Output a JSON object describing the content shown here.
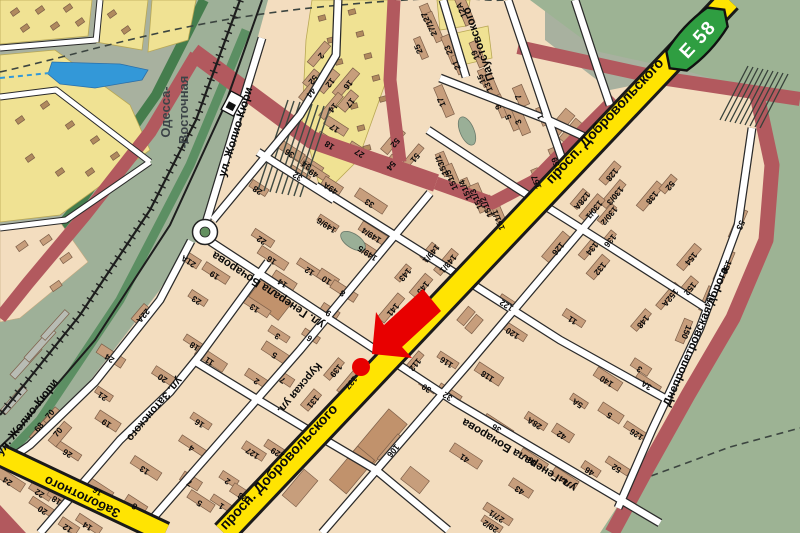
{
  "map": {
    "route_badge": {
      "text": "E 58",
      "color": "#2f9e41"
    },
    "station": {
      "line1": "Одесса-",
      "line2": "-Восточная"
    },
    "marker": {
      "type": "arrow-and-dot",
      "color": "#e80000"
    },
    "street_labels": [
      {
        "text": "просп. Добровольского",
        "x": 608,
        "y": 124,
        "r": -47,
        "s": 14
      },
      {
        "text": "просп. Добровольского",
        "x": 282,
        "y": 470,
        "r": -47,
        "s": 14
      },
      {
        "text": "Заболотного",
        "x": 84,
        "y": 493,
        "r": 205,
        "s": 13
      },
      {
        "text": "ул. Жолио-Кюри",
        "x": 239,
        "y": 133,
        "r": -73,
        "s": 11.5
      },
      {
        "text": "ул. Жолио-Кюри",
        "x": 30,
        "y": 419,
        "r": -52,
        "s": 11.5
      },
      {
        "text": "ул. Затонского",
        "x": 152,
        "y": 407,
        "r": 130,
        "s": 11
      },
      {
        "text": "Курская ул.",
        "x": 297,
        "y": 386,
        "r": 130,
        "s": 11
      },
      {
        "text": "ул. Генерала Бочарова",
        "x": 270,
        "y": 287,
        "r": 213,
        "s": 11.5
      },
      {
        "text": "ул. Генерала Бочарова",
        "x": 521,
        "y": 452,
        "r": 211,
        "s": 11.5
      },
      {
        "text": "Паустовского",
        "x": 482,
        "y": 43,
        "r": 251,
        "s": 11.5
      },
      {
        "text": "Днепропетровская дорога",
        "x": 699,
        "y": 338,
        "r": -67,
        "s": 11.5
      }
    ],
    "numbers": [
      {
        "t": "143",
        "x": 403,
        "y": 273,
        "r": 130
      },
      {
        "t": "145",
        "x": 421,
        "y": 286,
        "r": 130
      },
      {
        "t": "141",
        "x": 391,
        "y": 308,
        "r": 130
      },
      {
        "t": "139",
        "x": 334,
        "y": 369,
        "r": 130
      },
      {
        "t": "137",
        "x": 349,
        "y": 381,
        "r": 130
      },
      {
        "t": "131",
        "x": 311,
        "y": 400,
        "r": 130
      },
      {
        "t": "143/1",
        "x": 446,
        "y": 262,
        "r": 130
      },
      {
        "t": "149/1",
        "x": 429,
        "y": 252,
        "r": 130
      },
      {
        "t": "112",
        "x": 413,
        "y": 363,
        "r": 130
      },
      {
        "t": "126",
        "x": 556,
        "y": 247,
        "r": 130
      },
      {
        "t": "128",
        "x": 610,
        "y": 173,
        "r": 130
      },
      {
        "t": "130/3",
        "x": 613,
        "y": 194,
        "r": 130
      },
      {
        "t": "130/2",
        "x": 607,
        "y": 214,
        "r": 130
      },
      {
        "t": "130/1",
        "x": 592,
        "y": 208,
        "r": 130
      },
      {
        "t": "128А",
        "x": 580,
        "y": 199,
        "r": 130
      },
      {
        "t": "134",
        "x": 590,
        "y": 247,
        "r": 130
      },
      {
        "t": "136",
        "x": 608,
        "y": 239,
        "r": 130
      },
      {
        "t": "132",
        "x": 598,
        "y": 267,
        "r": 130
      },
      {
        "t": "138",
        "x": 650,
        "y": 196,
        "r": 130
      },
      {
        "t": "148",
        "x": 641,
        "y": 320,
        "r": 130
      },
      {
        "t": "152А",
        "x": 668,
        "y": 296,
        "r": 130
      },
      {
        "t": "152",
        "x": 688,
        "y": 287,
        "r": 130
      },
      {
        "t": "154",
        "x": 689,
        "y": 257,
        "r": 130
      },
      {
        "t": "52",
        "x": 668,
        "y": 184,
        "r": 130
      },
      {
        "t": "154",
        "x": 707,
        "y": 299,
        "r": 113
      },
      {
        "t": "156",
        "x": 724,
        "y": 266,
        "r": 113
      },
      {
        "t": "150",
        "x": 684,
        "y": 331,
        "r": 113
      },
      {
        "t": "53",
        "x": 738,
        "y": 224,
        "r": 113
      },
      {
        "t": "116",
        "x": 448,
        "y": 360,
        "r": 213
      },
      {
        "t": "118",
        "x": 489,
        "y": 374,
        "r": 213
      },
      {
        "t": "122",
        "x": 508,
        "y": 303,
        "r": 213
      },
      {
        "t": "120",
        "x": 514,
        "y": 331,
        "r": 213
      },
      {
        "t": "30",
        "x": 428,
        "y": 386,
        "r": 213
      },
      {
        "t": "32",
        "x": 449,
        "y": 394,
        "r": 213
      },
      {
        "t": "36",
        "x": 498,
        "y": 426,
        "r": 213
      },
      {
        "t": "28А",
        "x": 536,
        "y": 421,
        "r": 213
      },
      {
        "t": "40",
        "x": 534,
        "y": 459,
        "r": 213
      },
      {
        "t": "42",
        "x": 563,
        "y": 433,
        "r": 213
      },
      {
        "t": "44",
        "x": 565,
        "y": 478,
        "r": 213
      },
      {
        "t": "46",
        "x": 591,
        "y": 469,
        "r": 213
      },
      {
        "t": "52",
        "x": 618,
        "y": 466,
        "r": 213
      },
      {
        "t": "41",
        "x": 466,
        "y": 456,
        "r": 213
      },
      {
        "t": "43",
        "x": 521,
        "y": 488,
        "r": 213
      },
      {
        "t": "27/1",
        "x": 498,
        "y": 514,
        "r": 213
      },
      {
        "t": "29/2",
        "x": 492,
        "y": 524,
        "r": 213
      },
      {
        "t": "140",
        "x": 608,
        "y": 379,
        "r": 213
      },
      {
        "t": "3",
        "x": 641,
        "y": 367,
        "r": 213
      },
      {
        "t": "3А",
        "x": 648,
        "y": 383,
        "r": 213
      },
      {
        "t": "5А",
        "x": 579,
        "y": 401,
        "r": 213
      },
      {
        "t": "5",
        "x": 611,
        "y": 413,
        "r": 213
      },
      {
        "t": "106",
        "x": 391,
        "y": 449,
        "r": 130
      },
      {
        "t": "11",
        "x": 574,
        "y": 318,
        "r": 213
      },
      {
        "t": "126",
        "x": 638,
        "y": 432,
        "r": 213
      },
      {
        "t": "21А",
        "x": 190,
        "y": 259,
        "r": 213
      },
      {
        "t": "19",
        "x": 216,
        "y": 273,
        "r": 213
      },
      {
        "t": "23",
        "x": 198,
        "y": 298,
        "r": 213
      },
      {
        "t": "18",
        "x": 196,
        "y": 344,
        "r": 213
      },
      {
        "t": "11",
        "x": 211,
        "y": 359,
        "r": 213
      },
      {
        "t": "20",
        "x": 164,
        "y": 376,
        "r": 213
      },
      {
        "t": "13",
        "x": 256,
        "y": 306,
        "r": 213
      },
      {
        "t": "3",
        "x": 279,
        "y": 334,
        "r": 213
      },
      {
        "t": "5",
        "x": 276,
        "y": 353,
        "r": 213
      },
      {
        "t": "7",
        "x": 284,
        "y": 378,
        "r": 213
      },
      {
        "t": "2",
        "x": 258,
        "y": 379,
        "r": 213
      },
      {
        "t": "6",
        "x": 311,
        "y": 336,
        "r": 213
      },
      {
        "t": "14",
        "x": 284,
        "y": 281,
        "r": 213
      },
      {
        "t": "16",
        "x": 273,
        "y": 258,
        "r": 213
      },
      {
        "t": "22",
        "x": 263,
        "y": 238,
        "r": 213
      },
      {
        "t": "12",
        "x": 311,
        "y": 269,
        "r": 213
      },
      {
        "t": "10",
        "x": 328,
        "y": 278,
        "r": 213
      },
      {
        "t": "8",
        "x": 344,
        "y": 291,
        "r": 213
      },
      {
        "t": "9",
        "x": 330,
        "y": 311,
        "r": 213
      },
      {
        "t": "26",
        "x": 69,
        "y": 451,
        "r": 213
      },
      {
        "t": "24",
        "x": 9,
        "y": 479,
        "r": 213
      },
      {
        "t": "22",
        "x": 41,
        "y": 491,
        "r": 213
      },
      {
        "t": "20",
        "x": 44,
        "y": 508,
        "r": 213
      },
      {
        "t": "18",
        "x": 58,
        "y": 498,
        "r": 213
      },
      {
        "t": "16",
        "x": 99,
        "y": 489,
        "r": 213
      },
      {
        "t": "12",
        "x": 69,
        "y": 526,
        "r": 213
      },
      {
        "t": "14",
        "x": 89,
        "y": 524,
        "r": 213
      },
      {
        "t": "21",
        "x": 104,
        "y": 394,
        "r": 213
      },
      {
        "t": "19",
        "x": 108,
        "y": 421,
        "r": 213
      },
      {
        "t": "13",
        "x": 146,
        "y": 468,
        "r": 213
      },
      {
        "t": "8",
        "x": 136,
        "y": 504,
        "r": 213
      },
      {
        "t": "4",
        "x": 193,
        "y": 446,
        "r": 213
      },
      {
        "t": "7",
        "x": 191,
        "y": 481,
        "r": 213
      },
      {
        "t": "5",
        "x": 201,
        "y": 501,
        "r": 213
      },
      {
        "t": "2",
        "x": 229,
        "y": 479,
        "r": 213
      },
      {
        "t": "1",
        "x": 223,
        "y": 504,
        "r": 213
      },
      {
        "t": "123",
        "x": 246,
        "y": 496,
        "r": 213
      },
      {
        "t": "127",
        "x": 254,
        "y": 451,
        "r": 213
      },
      {
        "t": "129",
        "x": 279,
        "y": 451,
        "r": 213
      },
      {
        "t": "16",
        "x": 201,
        "y": 421,
        "r": 213
      },
      {
        "t": "24",
        "x": 111,
        "y": 356,
        "r": 213
      },
      {
        "t": "22А",
        "x": 141,
        "y": 314,
        "r": 130
      },
      {
        "t": "68",
        "x": 41,
        "y": 429,
        "r": -50
      },
      {
        "t": "70",
        "x": 52,
        "y": 416,
        "r": -50
      },
      {
        "t": "70",
        "x": 60,
        "y": 434,
        "r": -50
      },
      {
        "t": "34",
        "x": 308,
        "y": 163,
        "r": 213
      },
      {
        "t": "32",
        "x": 299,
        "y": 174,
        "r": 213
      },
      {
        "t": "49",
        "x": 315,
        "y": 171,
        "r": 213
      },
      {
        "t": "49А",
        "x": 332,
        "y": 186,
        "r": 213
      },
      {
        "t": "36",
        "x": 291,
        "y": 151,
        "r": 213
      },
      {
        "t": "28",
        "x": 259,
        "y": 188,
        "r": 213
      },
      {
        "t": "27",
        "x": 361,
        "y": 151,
        "r": 213
      },
      {
        "t": "33",
        "x": 371,
        "y": 201,
        "r": 213
      },
      {
        "t": "17",
        "x": 336,
        "y": 126,
        "r": 213
      },
      {
        "t": "18",
        "x": 331,
        "y": 143,
        "r": 213
      },
      {
        "t": "149/6",
        "x": 328,
        "y": 223,
        "r": 213
      },
      {
        "t": "149/4",
        "x": 373,
        "y": 233,
        "r": 213
      },
      {
        "t": "149/5",
        "x": 369,
        "y": 251,
        "r": 213
      },
      {
        "t": "2",
        "x": 319,
        "y": 54,
        "r": 130
      },
      {
        "t": "52",
        "x": 311,
        "y": 78,
        "r": 130
      },
      {
        "t": "12",
        "x": 328,
        "y": 81,
        "r": 130
      },
      {
        "t": "16",
        "x": 346,
        "y": 83,
        "r": 130
      },
      {
        "t": "44",
        "x": 309,
        "y": 91,
        "r": 130
      },
      {
        "t": "14",
        "x": 331,
        "y": 106,
        "r": 130
      },
      {
        "t": "17",
        "x": 348,
        "y": 101,
        "r": 130
      },
      {
        "t": "52",
        "x": 393,
        "y": 141,
        "r": 130
      },
      {
        "t": "54",
        "x": 389,
        "y": 164,
        "r": 130
      },
      {
        "t": "51",
        "x": 413,
        "y": 156,
        "r": 130
      },
      {
        "t": "12А",
        "x": 464,
        "y": 9,
        "r": 247
      },
      {
        "t": "27",
        "x": 428,
        "y": 16,
        "r": 247
      },
      {
        "t": "27/1",
        "x": 434,
        "y": 27,
        "r": 247
      },
      {
        "t": "25",
        "x": 421,
        "y": 48,
        "r": 247
      },
      {
        "t": "23",
        "x": 451,
        "y": 49,
        "r": 247
      },
      {
        "t": "21",
        "x": 459,
        "y": 64,
        "r": 247
      },
      {
        "t": "19",
        "x": 478,
        "y": 54,
        "r": 247
      },
      {
        "t": "15",
        "x": 484,
        "y": 78,
        "r": 247
      },
      {
        "t": "13",
        "x": 491,
        "y": 86,
        "r": 247
      },
      {
        "t": "17",
        "x": 444,
        "y": 101,
        "r": 247
      },
      {
        "t": "9",
        "x": 501,
        "y": 106,
        "r": 247
      },
      {
        "t": "5",
        "x": 511,
        "y": 116,
        "r": 247
      },
      {
        "t": "7",
        "x": 521,
        "y": 96,
        "r": 247
      },
      {
        "t": "3",
        "x": 521,
        "y": 121,
        "r": 247
      },
      {
        "t": "1",
        "x": 543,
        "y": 116,
        "r": 247
      },
      {
        "t": "157",
        "x": 539,
        "y": 181,
        "r": 247
      },
      {
        "t": "159",
        "x": 559,
        "y": 163,
        "r": 247
      },
      {
        "t": "153/1",
        "x": 444,
        "y": 164,
        "r": 247
      },
      {
        "t": "151/5",
        "x": 454,
        "y": 179,
        "r": 247
      },
      {
        "t": "151/4",
        "x": 468,
        "y": 189,
        "r": 247
      },
      {
        "t": "151/3",
        "x": 479,
        "y": 198,
        "r": 247
      },
      {
        "t": "151/2",
        "x": 489,
        "y": 206,
        "r": 247
      },
      {
        "t": "151/1",
        "x": 501,
        "y": 219,
        "r": 247
      }
    ],
    "colors": {
      "background": "#a8b19f",
      "park": "#9db394",
      "urban": "#f3ddbf",
      "gardens": "#f0e293",
      "road_major": "#b2595e",
      "road_highway": "#ffe402",
      "road_minor": "#ffffff",
      "railway": "#1d1d1d",
      "water": "#3398d8",
      "route_badge": "#2f9e41",
      "building": "#c79e7c",
      "marker": "#e80000"
    }
  }
}
